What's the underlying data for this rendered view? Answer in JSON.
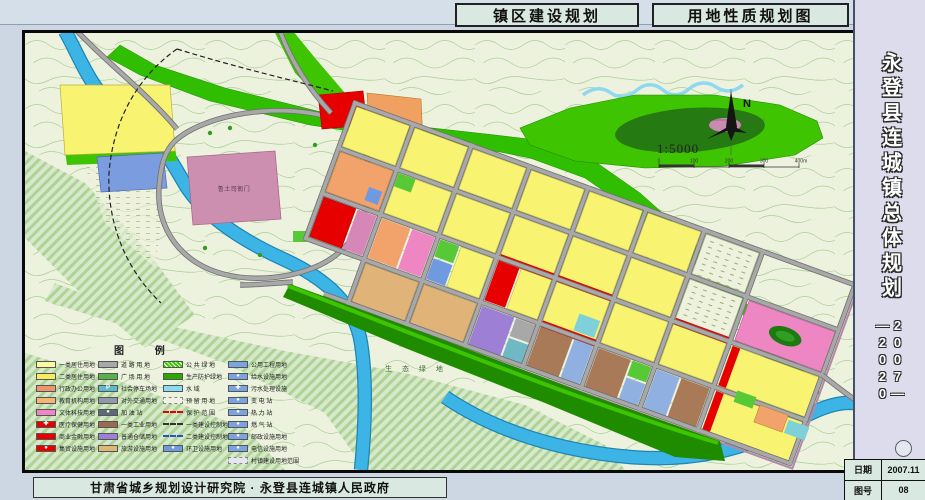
{
  "titles": {
    "left": "镇区建设规划",
    "right": "用地性质规划图"
  },
  "sidebar": {
    "title": "永登县连城镇总体规划",
    "period_right": "2007—",
    "period_left": "—2020"
  },
  "footer": {
    "credit": "甘肃省城乡规划设计研究院 · 永登县连城镇人民政府"
  },
  "info_table": {
    "date_label": "日期",
    "date_value": "2007.11",
    "sheet_label": "图号",
    "sheet_value": "08"
  },
  "map": {
    "labels": {
      "heritage": "鲁土司衙门",
      "eco_green": "生 态 绿 地"
    },
    "compass_n": "N",
    "scale_text": "1:5000",
    "scale_ticks": [
      "0",
      "100",
      "200",
      "300",
      "400m"
    ]
  },
  "legend": {
    "title": "图 例",
    "columns": [
      {
        "items": [
          {
            "label": "一类居住用地",
            "color": "#fdf9a0"
          },
          {
            "label": "二类居住用地",
            "color": "#f6ec5f"
          },
          {
            "label": "行政办公用地",
            "color": "#f0946a"
          },
          {
            "label": "教育机构用地",
            "color": "#f5b577"
          },
          {
            "label": "文体科技用地",
            "color": "#ef86c4"
          },
          {
            "label": "医疗保健用地",
            "color": "#e60000",
            "icon": "cross"
          },
          {
            "label": "商业金融用地",
            "color": "#e60000"
          },
          {
            "label": "集贸设施用地",
            "color": "#e60000",
            "icon": "dot"
          }
        ]
      },
      {
        "items": [
          {
            "label": "道 路 用 地",
            "color": "#a8a8a8"
          },
          {
            "label": "广 场 用 地",
            "color": "#58b24a"
          },
          {
            "label": "社会停车场地",
            "color": "#62b8cc",
            "icon": "P"
          },
          {
            "label": "对外交通用地",
            "color": "#8f9aa6"
          },
          {
            "label": "加 油 站",
            "color": "#5a6b7a",
            "icon": "dot"
          },
          {
            "label": "一类工业用地",
            "color": "#9c6b4f"
          },
          {
            "label": "普通仓储用地",
            "color": "#9d7fd6"
          },
          {
            "label": "旅游设施用地",
            "color": "#dbb878"
          }
        ]
      },
      {
        "items": [
          {
            "label": "公 共 绿 地",
            "color": "#3ecc00",
            "style": "hatch"
          },
          {
            "label": "生产防护绿地",
            "color": "#2aa800"
          },
          {
            "label": "水  域",
            "color": "#8adcf2"
          },
          {
            "label": "预 留 用 地",
            "color": "#f2f2e4",
            "style": "reserve"
          },
          {
            "label": "保 护 范 围",
            "style": "line-red"
          },
          {
            "label": "一类建设控制地带",
            "style": "line-dark"
          },
          {
            "label": "二类建设控制地带",
            "style": "line-blue"
          },
          {
            "label": "环卫设施用地",
            "color": "#6f9ae0",
            "icon": "dot"
          }
        ]
      },
      {
        "items": [
          {
            "label": "公用工程用地",
            "color": "#7ba3e0"
          },
          {
            "label": "给水设施用地",
            "color": "#7ba3e0",
            "icon": "dot"
          },
          {
            "label": "污水处理设施",
            "color": "#7ba3e0",
            "icon": "cross"
          },
          {
            "label": "变 电 站",
            "color": "#7ba3e0",
            "icon": "dot"
          },
          {
            "label": "热 力 站",
            "color": "#7ba3e0",
            "icon": "dot"
          },
          {
            "label": "燃 气 站",
            "color": "#7ba3e0",
            "icon": "dot"
          },
          {
            "label": "邮政设施用地",
            "color": "#7ba3e0",
            "icon": "dot"
          },
          {
            "label": "电信设施用地",
            "color": "#7ba3e0",
            "icon": "dot"
          },
          {
            "label": "村镇建设用地范围",
            "color": "#e4e8ee",
            "style": "reserve"
          }
        ]
      }
    ]
  },
  "colors": {
    "page_bg": "#ccd7e3",
    "panel_bg": "#d9e8e0",
    "sidebar_bg": "#dcdcec",
    "map_bg": "#edf2de",
    "protect_green": "#2fbe00",
    "water": "#3cb4e6",
    "road_gray": "#a8a8a8",
    "commercial_red": "#e60000",
    "residential_yellow": "#f8f370"
  }
}
